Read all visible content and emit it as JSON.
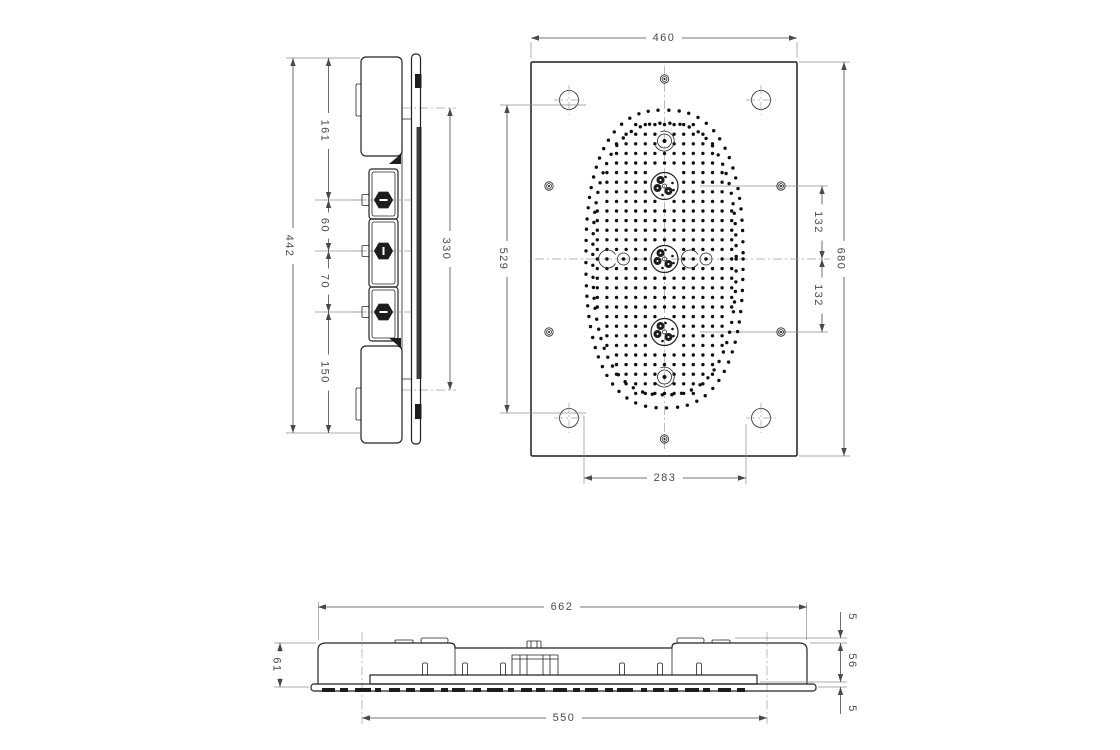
{
  "drawing": {
    "views": {
      "side": {
        "label": "side view",
        "dims": {
          "overall_height": "442",
          "top_to_first_valve": "161",
          "first_to_second_valve": "60",
          "second_to_third_valve": "70",
          "third_valve_to_bottom": "150",
          "bracket_span": "330"
        }
      },
      "front": {
        "label": "front view",
        "dims": {
          "panel_width": "460",
          "spray_field_height": "529",
          "panel_height": "680",
          "upper_cluster_spacing": "132",
          "lower_cluster_spacing": "132",
          "spray_field_width": "283"
        }
      },
      "profile": {
        "label": "bottom profile view",
        "dims": {
          "overall_width": "662",
          "overall_depth": "61",
          "ceiling_gap": "5",
          "housing_depth": "56",
          "panel_lip": "5",
          "mounting_span": "550"
        }
      }
    }
  }
}
